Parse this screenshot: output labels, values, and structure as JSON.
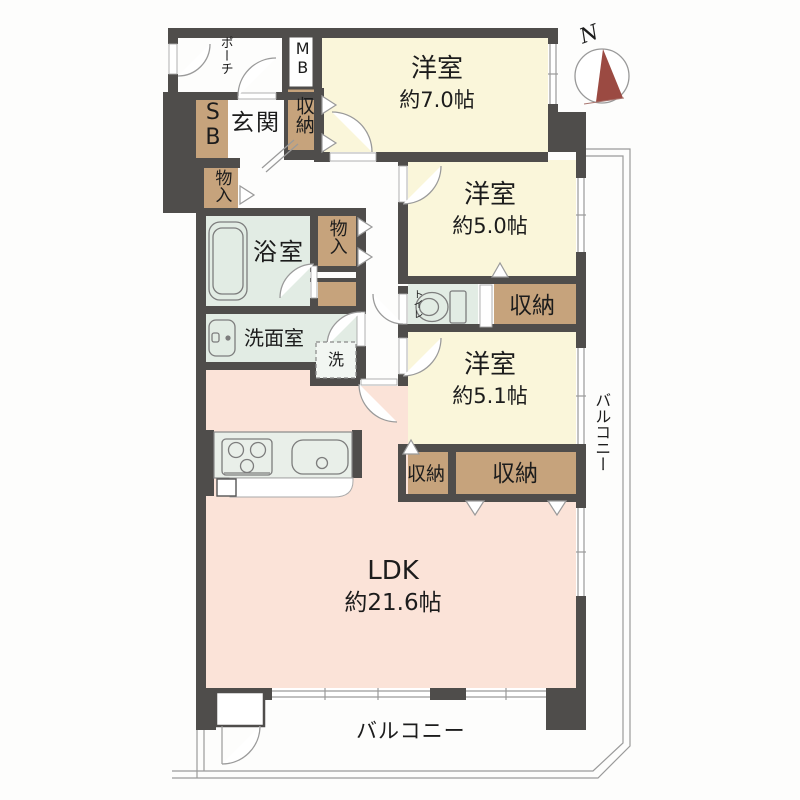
{
  "title": "マンション間取り図 3LDK",
  "colors": {
    "wall": "#4f4d4b",
    "room_yellow": "#faf6da",
    "room_pink": "#fbe3d8",
    "room_green": "#e2ece4",
    "storage_tan": "#c6a37c",
    "fixture_fill": "#e9efe9",
    "needle_maroon": "#9b4a42",
    "line_gray": "#9a9a9a",
    "text": "#1c1c1c"
  },
  "compass": {
    "north": "N"
  },
  "rooms": {
    "porch": {
      "label": "ポーチ"
    },
    "meter_box": {
      "label": "MB"
    },
    "shoe_box": {
      "label": "SB"
    },
    "entrance": {
      "label": "玄関"
    },
    "entrance_closet": {
      "label": "収納"
    },
    "hall_storage": {
      "label": "物入"
    },
    "bedroom_7": {
      "name": "洋室",
      "size": "約7.0帖"
    },
    "bedroom_50": {
      "name": "洋室",
      "size": "約5.0帖"
    },
    "bedroom_51": {
      "name": "洋室",
      "size": "約5.1帖"
    },
    "bathroom": {
      "label": "浴室"
    },
    "bath_storage": {
      "label": "物入"
    },
    "washroom": {
      "label": "洗面室"
    },
    "laundry": {
      "label": "洗"
    },
    "toilet": {
      "label": "トイレ"
    },
    "bedroom50_closet": {
      "label": "収納"
    },
    "closet_small": {
      "label": "収納"
    },
    "closet_large": {
      "label": "収納"
    },
    "ldk": {
      "name": "LDK",
      "size": "約21.6帖"
    },
    "balcony_south": {
      "label": "バルコニー"
    },
    "balcony_east": {
      "label": "バルコニー"
    }
  }
}
